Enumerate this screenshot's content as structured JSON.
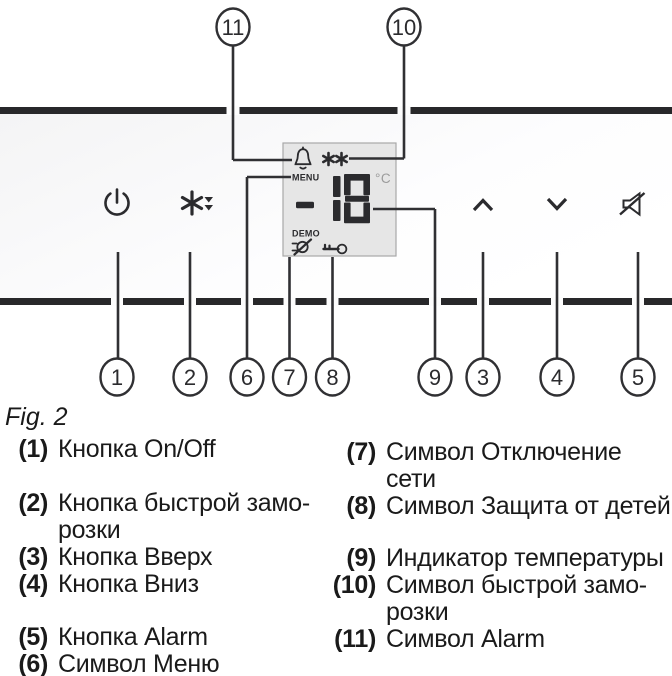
{
  "figure": {
    "caption": "Fig. 2",
    "callout_numbers": {
      "n1": "1",
      "n2": "2",
      "n3": "3",
      "n4": "4",
      "n5": "5",
      "n6": "6",
      "n7": "7",
      "n8": "8",
      "n9": "9",
      "n10": "10",
      "n11": "11"
    },
    "display": {
      "menu_label": "MENU",
      "demo_label": "DEMO",
      "temperature_value": "18",
      "temperature_unit": "°C",
      "fast_freeze_indicator": "**"
    },
    "icons": {
      "power": "power-icon",
      "fast_freeze": "snowflake-down-arrows-icon",
      "alarm_bell": "bell-icon",
      "up": "chevron-up-icon",
      "down": "chevron-down-icon",
      "mute": "muted-speaker-icon",
      "mains_disconnect": "crossed-plug-icon",
      "child_lock": "key-icon"
    },
    "colors": {
      "bar": "#28282a",
      "line": "#303033",
      "panel_bg": "#f5f5f6",
      "display_bg": "#e6e6e6",
      "display_border": "#a8a8a8",
      "unit_gray": "#9b9b9b",
      "text": "#1a1a1a"
    }
  },
  "legend": {
    "items": [
      {
        "num": "(1)",
        "lines": [
          "Кнопка On/Off"
        ]
      },
      {
        "num": "(2)",
        "lines": [
          "Кнопка быстрой замо-",
          "розки"
        ]
      },
      {
        "num": "(3)",
        "lines": [
          "Кнопка Вверх"
        ]
      },
      {
        "num": "(4)",
        "lines": [
          "Кнопка Вниз"
        ]
      },
      {
        "num": "(5)",
        "lines": [
          "Кнопка Alarm"
        ]
      },
      {
        "num": "(6)",
        "lines": [
          "Символ Меню"
        ]
      },
      {
        "num": "(7)",
        "lines": [
          "Символ Отключение",
          "сети"
        ]
      },
      {
        "num": "(8)",
        "lines": [
          "Символ Защита от детей"
        ]
      },
      {
        "num": "(9)",
        "lines": [
          "Индикатор температуры"
        ]
      },
      {
        "num": "(10)",
        "lines": [
          "Символ быстрой замо-",
          "розки"
        ]
      },
      {
        "num": "(11)",
        "lines": [
          "Символ Alarm"
        ]
      }
    ]
  }
}
